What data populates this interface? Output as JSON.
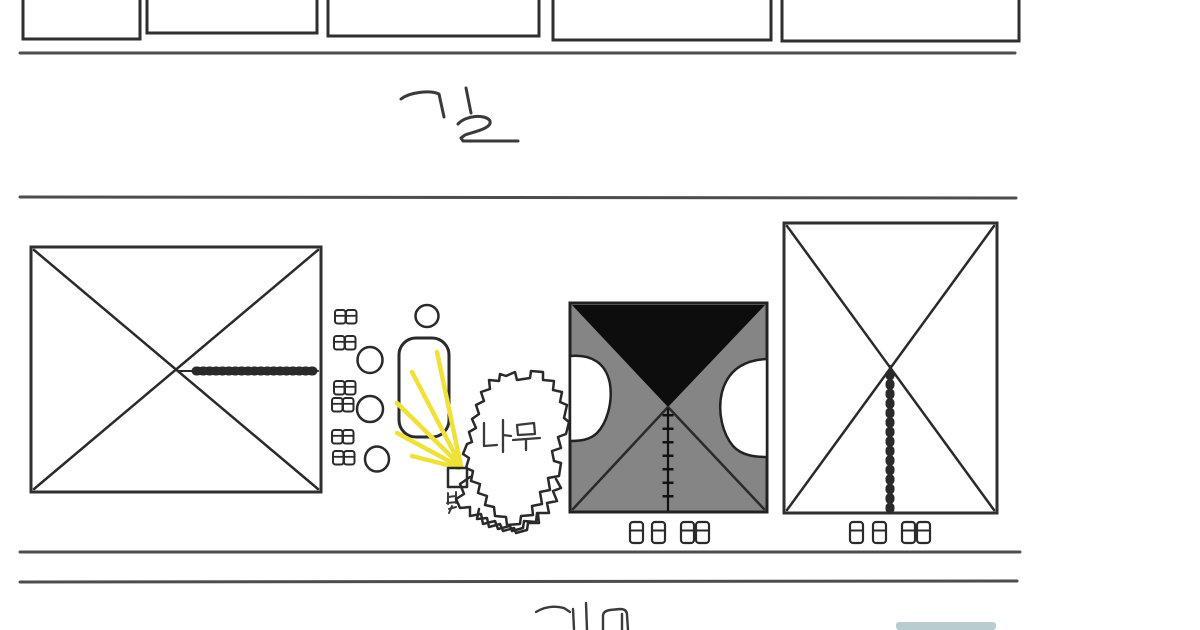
{
  "canvas": {
    "width": 1200,
    "height": 630,
    "background": "#ffffff"
  },
  "labels": {
    "top_road": "길",
    "tree": "나무",
    "light": "빛",
    "bottom_partial": "계"
  },
  "colors": {
    "ink": "#2a2a2a",
    "road_line": "#4d4d4d",
    "center_building_gray": "#858585",
    "roof_black": "#0d0d0d",
    "light_ray_yellow": "#f0e13a",
    "bottom_bar_teal": "#7fa3a8",
    "background": "#ffffff"
  },
  "scene": {
    "top_building_row": {
      "count": 5,
      "style": "outlined rectangles cut off by top edge"
    },
    "upper_road": {
      "label": "길",
      "line_count": 2
    },
    "left_building": {
      "style": "white box with X diagonals",
      "detail": "horizontal tick (hatch) line from center to right edge"
    },
    "left_cluster": {
      "desk_pairs": 6,
      "circles": 3,
      "pill_bench": 1,
      "small_circle": 1
    },
    "light_source": {
      "label": "빛",
      "shape": "small square",
      "ray_count": 5
    },
    "tree": {
      "label": "나무",
      "style": "jagged blob with layered bushes below"
    },
    "center_building": {
      "style": "gray box with black triangular roof, X diagonals, two white side notches, vertical tick line"
    },
    "right_building": {
      "style": "white box with X diagonals, vertical tick line"
    },
    "desk_row_below_center": {
      "count": 4
    },
    "desk_row_below_right": {
      "count": 4
    },
    "lower_road": {
      "line_count": 2,
      "label_partial": "계",
      "label_note_visible": "계"
    },
    "bottom_partial_bar": {
      "style": "faint teal bar cut by bottom edge"
    }
  }
}
